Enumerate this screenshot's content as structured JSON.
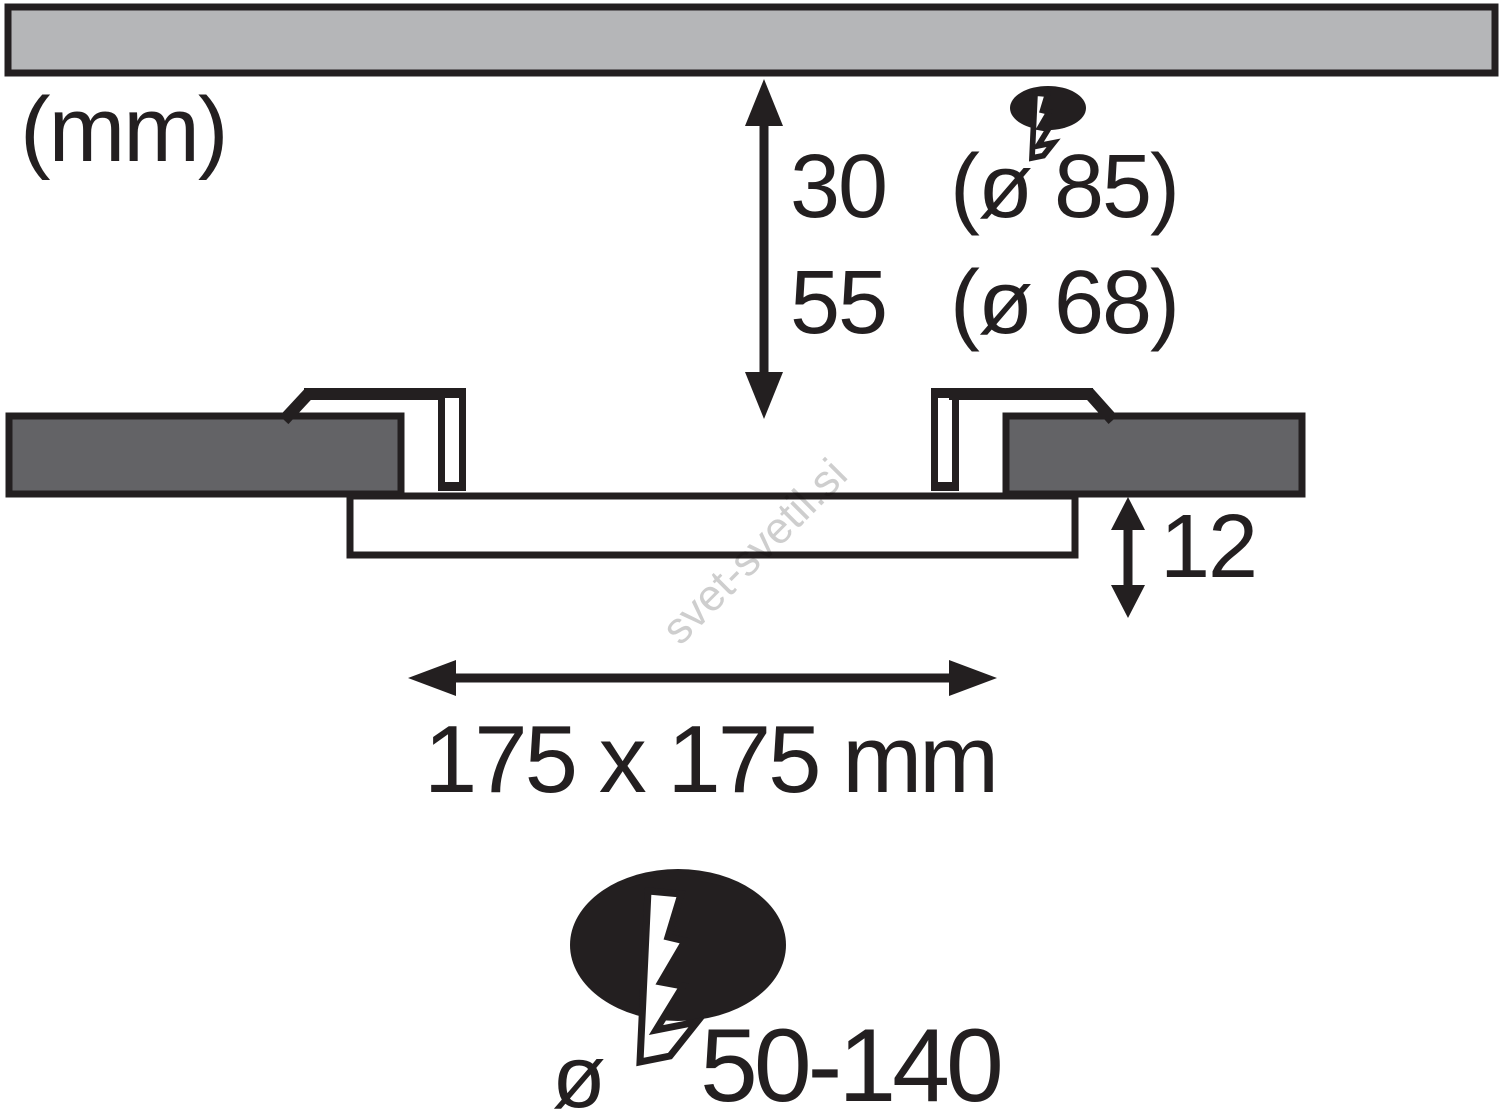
{
  "units_label": "(mm)",
  "depth_dimension": {
    "rows": [
      {
        "value": "30",
        "detail": "(ø 85)"
      },
      {
        "value": "55",
        "detail": "(ø 68)"
      }
    ]
  },
  "panel_height_label": "12",
  "cutout_size_label": "175 x 175 mm",
  "cable_cutout": {
    "diameter_symbol": "ø",
    "range_label": "50-140"
  },
  "watermark": "svet-svetil.si",
  "colors": {
    "line": "#231f20",
    "ceiling_fill": "#b5b6b8",
    "cut_block_fill": "#636366",
    "bolt_fill": "#ffffff",
    "panel_fill": "#ffffff",
    "watermark": "#c9c9c9",
    "background": "#ffffff"
  },
  "icons": {
    "small": "junction-box-lightning-icon",
    "large": "junction-box-lightning-icon"
  }
}
